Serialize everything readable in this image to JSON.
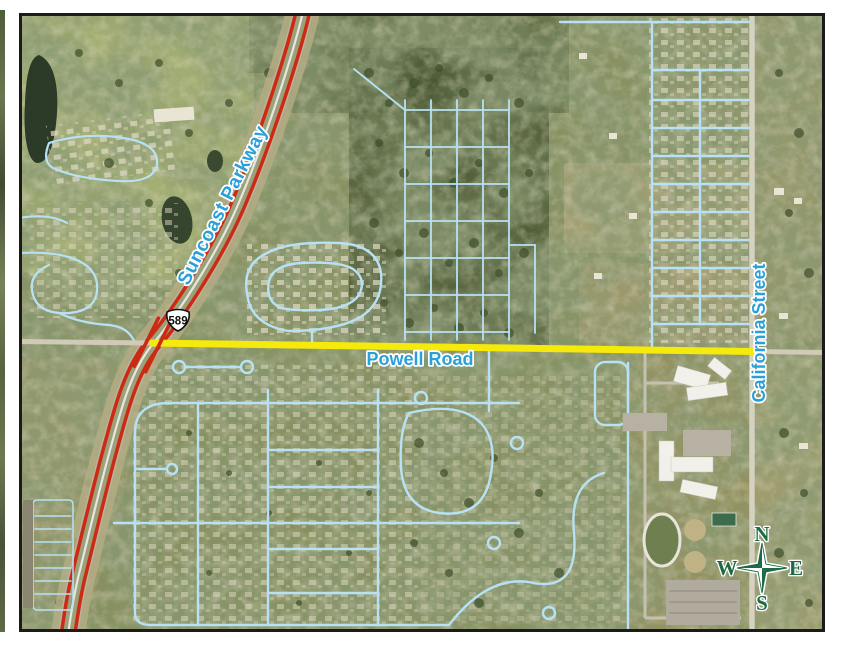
{
  "figure": {
    "type": "aerial-map",
    "labels": {
      "suncoast_parkway": "Suncoast Parkway",
      "powell_road": "Powell Road",
      "california_street": "California Street"
    },
    "route_shield": {
      "number": "589"
    },
    "compass": {
      "n": "N",
      "e": "E",
      "s": "S",
      "w": "W"
    },
    "colors": {
      "highway_red": "#cc2a12",
      "highlight_yellow": "#f6e90c",
      "label_blue": "#2ba0d8",
      "compass_green": "#1c6b45",
      "street_blue": "#b7e1f4",
      "shield_fill": "#ffffff",
      "shield_text": "#111111"
    }
  }
}
